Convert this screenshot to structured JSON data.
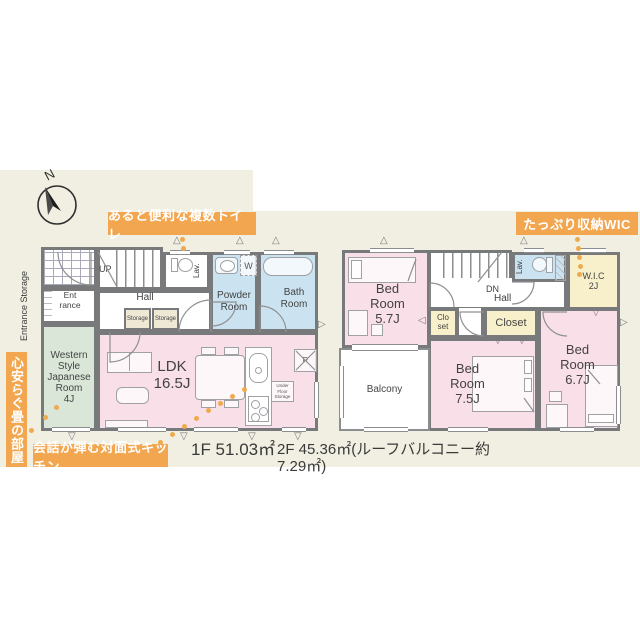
{
  "meta": {
    "type": "real-estate floor plan",
    "floors": 2
  },
  "colors": {
    "background_card": "#f0efe1",
    "wall": "#77797b",
    "room_pink": "#f9dfe8",
    "room_blue": "#cbe3f1",
    "room_green": "#d9e6d8",
    "room_yellow": "#f7f0ca",
    "accent_orange": "#f2a64f",
    "text_dark": "#3d3d3d"
  },
  "compass": {
    "north": "N"
  },
  "callouts": {
    "toilet": "あると便利な複数トイレ",
    "wic": "たっぷり収納WIC",
    "kitchen": "会話が弾む対面式キッチン",
    "tatami": "心安らぐ畳の部屋"
  },
  "areas": {
    "floor1": "1F 51.03㎡",
    "floor2": "2F 45.36㎡(ルーフバルコニー約7.29㎡)"
  },
  "floor1": {
    "entrance_storage": "Entrance Storage",
    "entrance": "Ent\nrance",
    "up": "UP",
    "hall": "Hall",
    "storage": "Storage",
    "lav": "Lav.",
    "powder_room": "Powder\nRoom",
    "washer": "W",
    "bath_room": "Bath\nRoom",
    "japanese_room": "Western\nStyle\nJapanese\nRoom\n4J",
    "ldk": "LDK\n16.5J",
    "fridge": "R",
    "under_floor_storage": "Under\nFloor\nStorage"
  },
  "floor2": {
    "bed1": "Bed\nRoom\n5.7J",
    "dn": "DN",
    "hall": "Hall",
    "lav": "Lav.",
    "wic": "W.I.C\n2J",
    "closet_small": "Clo\nset",
    "closet": "Closet",
    "bed2": "Bed\nRoom\n7.5J",
    "bed3": "Bed\nRoom\n6.7J",
    "balcony": "Balcony"
  },
  "icons": {
    "tri_up": "△",
    "tri_down": "▽",
    "tri_right": "▷",
    "tri_left": "◁"
  }
}
